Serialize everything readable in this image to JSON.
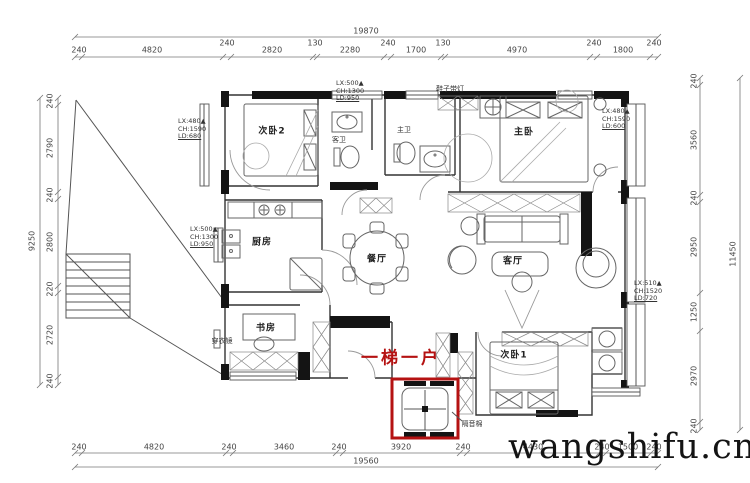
{
  "watermark": "wangshifu.cn",
  "highlight": {
    "label": "一梯一户",
    "box_color": "#b51212"
  },
  "rooms": {
    "bedroom2": "次卧2",
    "guest_bath": "客卫",
    "master_bath": "主卫",
    "master_bedroom": "主卧",
    "kitchen": "厨房",
    "dining": "餐厅",
    "living": "客厅",
    "study": "书房",
    "bedroom1": "次卧1"
  },
  "labels": {
    "mirror": "穿衣镜",
    "shoe_cabinet": "鞋子带灯",
    "soundproof": "隔音棉"
  },
  "window_annotations": {
    "w1": [
      "LX:480▲",
      "CH:1590",
      "LD:680"
    ],
    "w2": [
      "LX:500▲",
      "CH:1300",
      "LD:950"
    ],
    "w3": [
      "LX:480▲",
      "CH:1590",
      "LD:600"
    ],
    "w4": [
      "LX:500▲",
      "CH:1300",
      "LD:950"
    ],
    "w5": [
      "LX:510▲",
      "CH:1520",
      "LD:720"
    ]
  },
  "dimensions": {
    "top": {
      "total": "19870",
      "segments": [
        "240",
        "4820",
        "240",
        "2820",
        "130",
        "2280",
        "240",
        "1700",
        "130",
        "4970",
        "240",
        "1800",
        "240"
      ]
    },
    "bottom": {
      "total": "19560",
      "segments": [
        "240",
        "4820",
        "240",
        "3460",
        "240",
        "3920",
        "240",
        "4430",
        "240",
        "1500",
        "240"
      ]
    },
    "left": {
      "total": "9250",
      "segments": [
        "240",
        "2790",
        "240",
        "2800",
        "220",
        "2720",
        "240"
      ]
    },
    "right": {
      "total": "11450",
      "segments": [
        "240",
        "3560",
        "240",
        "2950",
        "1250",
        "2970",
        "240"
      ]
    }
  },
  "colors": {
    "wall": "#141414",
    "line": "#444444",
    "highlight": "#b51212",
    "watermark": "#141414"
  }
}
